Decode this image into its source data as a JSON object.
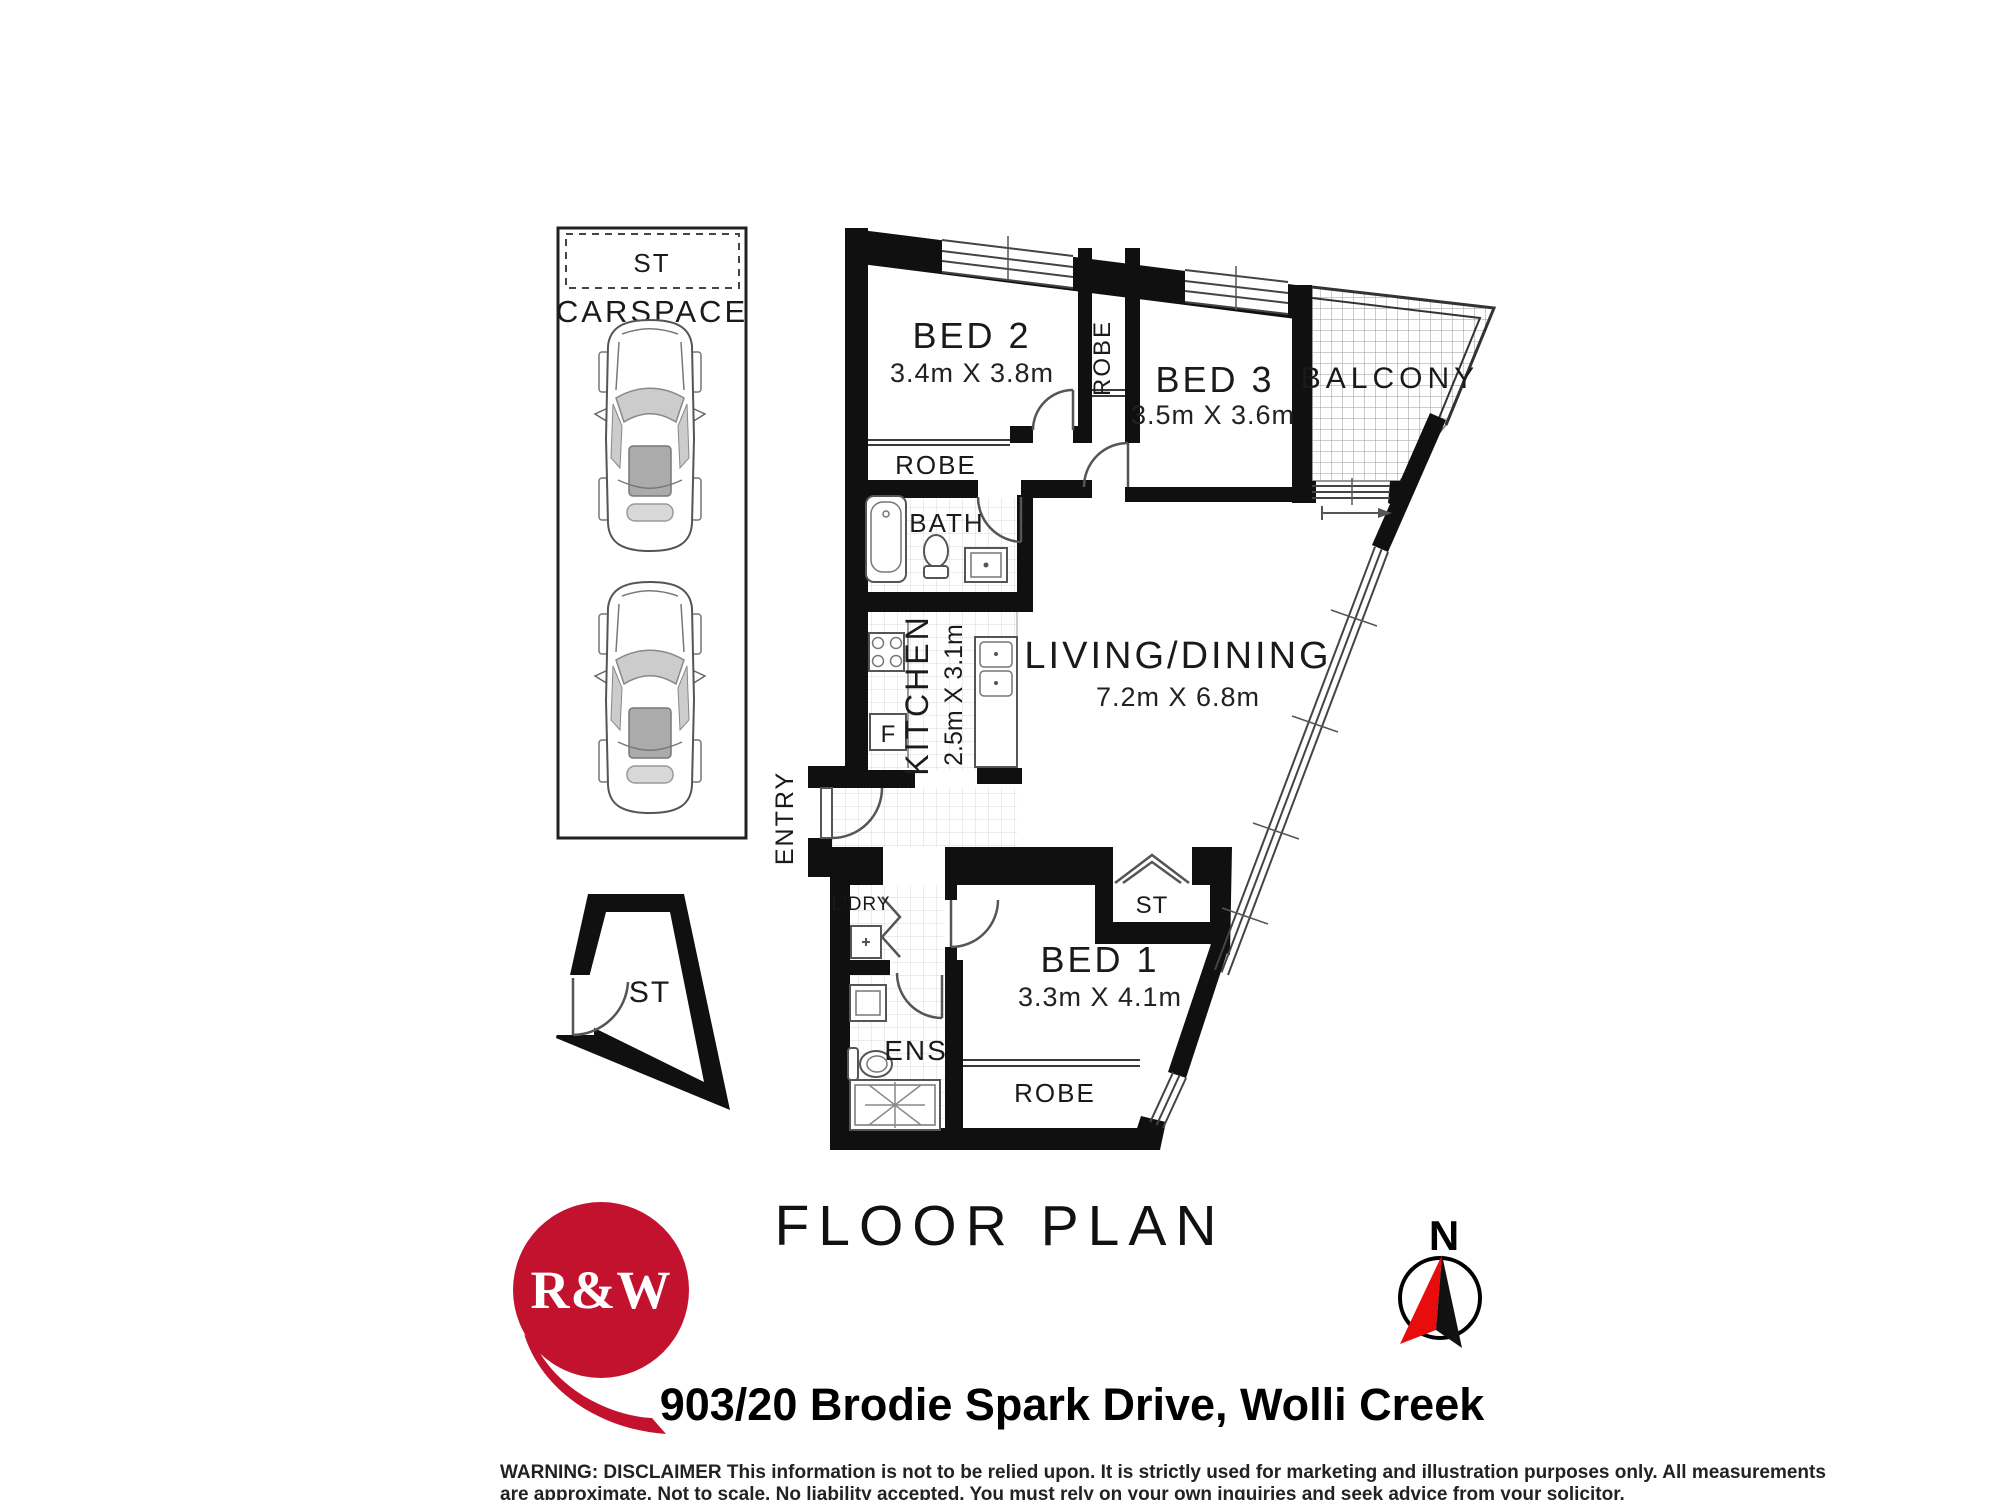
{
  "title": "FLOOR PLAN",
  "address": "903/20 Brodie Spark Drive, Wolli Creek",
  "logo": {
    "text": "R&W",
    "color": "#c2122d"
  },
  "compass": {
    "north_label": "N"
  },
  "carspace": {
    "label": "CARSPACE",
    "storage_label": "ST"
  },
  "storage_room": {
    "label": "ST"
  },
  "rooms": {
    "bed1": {
      "name": "BED 1",
      "dims": "3.3m X 4.1m"
    },
    "bed2": {
      "name": "BED 2",
      "dims": "3.4m X 3.8m"
    },
    "bed3": {
      "name": "BED 3",
      "dims": "3.5m X 3.6m"
    },
    "living": {
      "name": "LIVING/DINING",
      "dims": "7.2m X 6.8m"
    },
    "kitchen": {
      "name": "KITCHEN",
      "dims": "2.5m X 3.1m"
    },
    "balcony": {
      "name": "BALCONY"
    },
    "bath": {
      "name": "BATH"
    },
    "ens": {
      "name": "ENS"
    },
    "laundry": {
      "name": "L'DRY"
    },
    "entry": {
      "name": "ENTRY"
    },
    "robe_bed2": {
      "name": "ROBE"
    },
    "robe_mid": {
      "name": "ROBE"
    },
    "robe_bed1": {
      "name": "ROBE"
    },
    "st_living": {
      "name": "ST"
    }
  },
  "appliances": {
    "fridge": "F"
  },
  "disclaimer": {
    "line1": "WARNING: DISCLAIMER This information is not to be relied upon. It is strictly used for marketing and illustration purposes only. All measurements",
    "line2": "are approximate. Not to scale. No liability accepted. You must rely on your own inquiries and seek advice from your solicitor."
  }
}
